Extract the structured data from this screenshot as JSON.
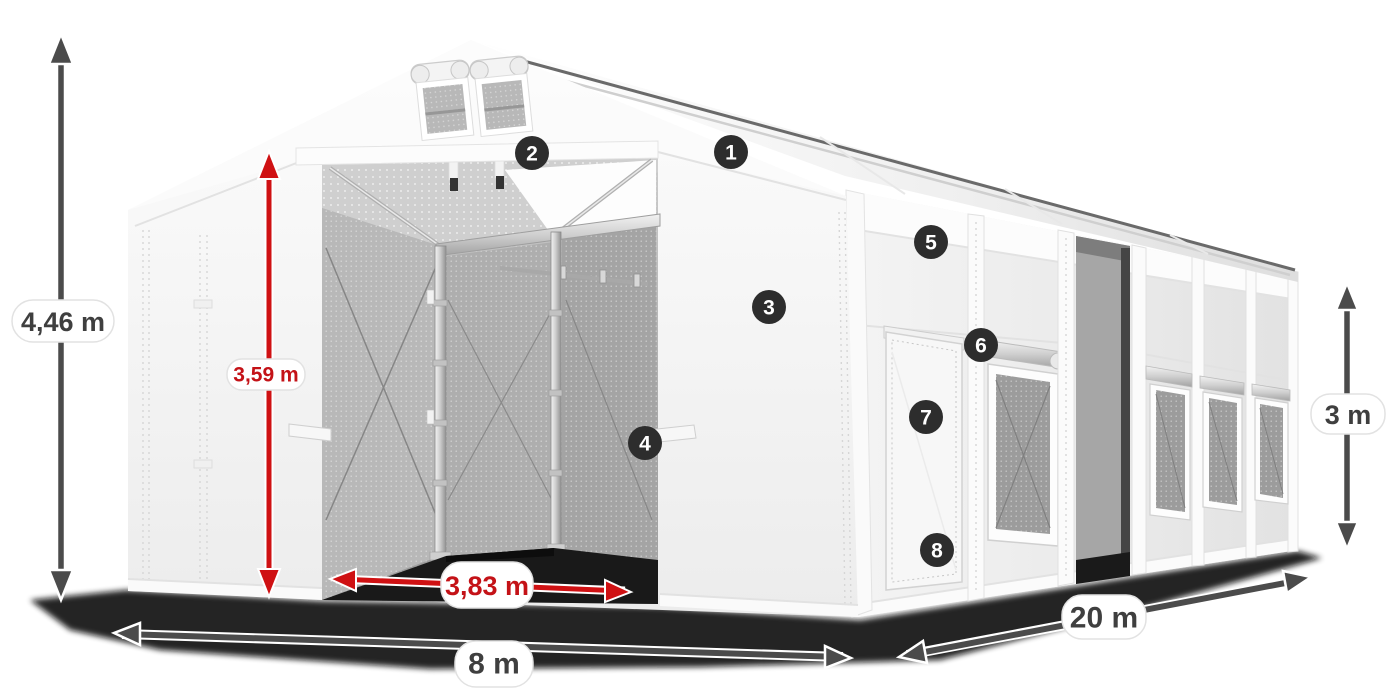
{
  "diagram": {
    "dimensions": {
      "total_height": {
        "label": "4,46 m"
      },
      "entrance_height": {
        "label": "3,59 m"
      },
      "entrance_width": {
        "label": "3,83 m"
      },
      "width": {
        "label": "8 m"
      },
      "length": {
        "label": "20 m"
      },
      "wall_height": {
        "label": "3 m"
      }
    },
    "markers": [
      {
        "label": "1"
      },
      {
        "label": "2"
      },
      {
        "label": "3"
      },
      {
        "label": "4"
      },
      {
        "label": "5"
      },
      {
        "label": "6"
      },
      {
        "label": "7"
      },
      {
        "label": "8"
      }
    ],
    "colors": {
      "dimension_red": "#cf1113",
      "dimension_gray": "#4b4b4b",
      "marker_background": "#2d2d2d",
      "marker_text": "#ffffff",
      "pill_background": "#ffffff",
      "tent_white": "#f7f7f7",
      "interior_gray": "#a8a8a8",
      "shadow_black": "#0c0c0c"
    }
  }
}
